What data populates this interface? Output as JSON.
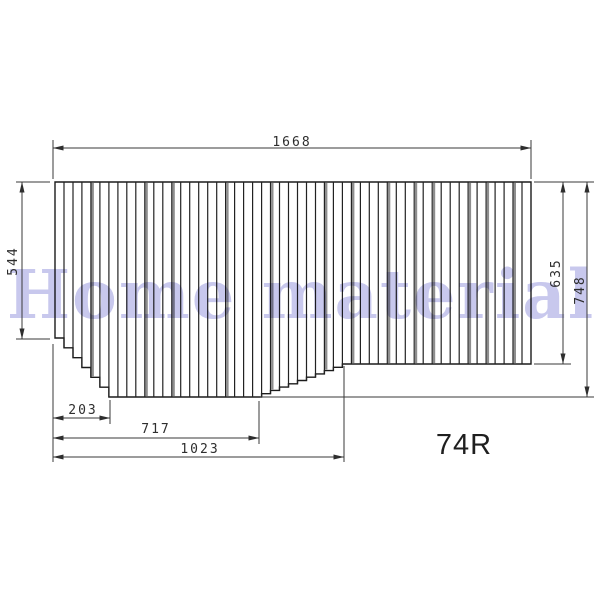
{
  "page": {
    "background": "#ffffff"
  },
  "watermark": {
    "text": "Home material",
    "color": "#c3c3ec"
  },
  "drawing": {
    "kind": "technical-dimension-drawing",
    "subject": "shutter-type folding bath lid panel, right-hand version",
    "part_label": "74R",
    "dimension_labels": {
      "overall_width": "1668",
      "left_height": "544",
      "right_height": "635",
      "overall_height": "748",
      "bottom_left_step": "203",
      "bottom_middle": "717",
      "bottom_right_step": "1023"
    },
    "geometry": {
      "panel": {
        "x0": 55,
        "x1": 531,
        "top": 182,
        "left_bottom": 338,
        "deep_bottom": 397,
        "right_bottom": 364
      },
      "slat_count": 53,
      "left_step_last_slat": 6,
      "deep_last_slat": 22,
      "rise_last_slat": 31,
      "gray_boundaries": [
        4,
        10,
        13,
        19,
        24,
        30,
        33,
        37,
        40,
        42,
        46,
        48,
        51
      ],
      "fill": "#ffffff",
      "outline_color": "#1b1b1b",
      "line_color": "#222222",
      "gray_line_color": "#8e8e8e"
    }
  }
}
